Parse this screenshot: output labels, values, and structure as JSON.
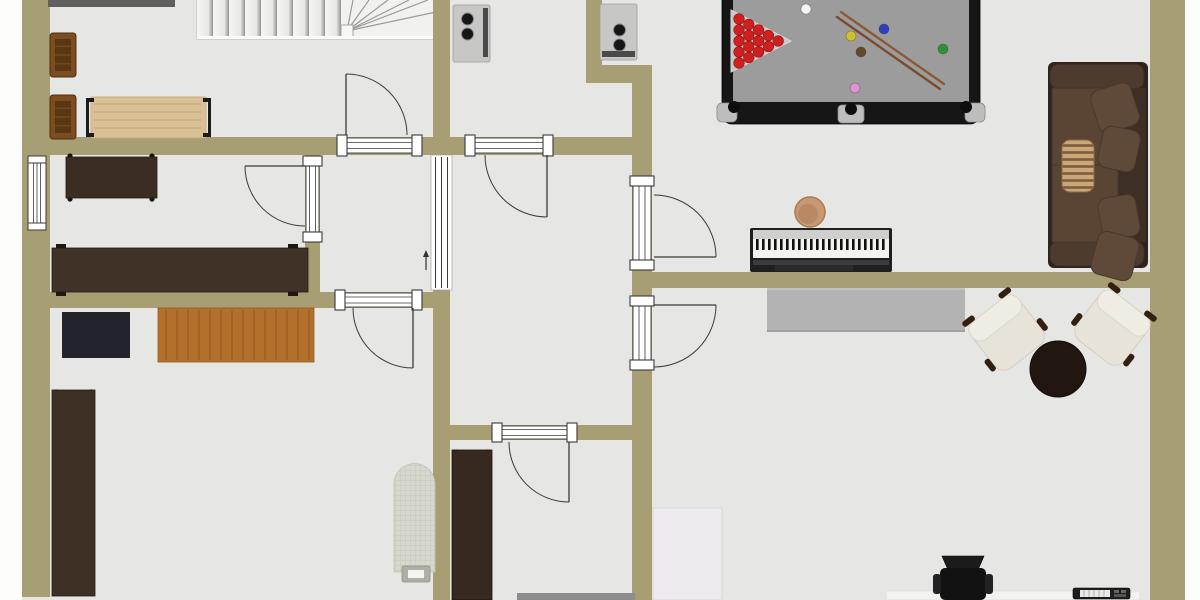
{
  "canvas": {
    "w": 1200,
    "h": 600,
    "bg": "#fdfdfc",
    "floor_color": "#e6e6e5",
    "wall_color": "#a89e73",
    "line_color": "#3a3a3a"
  },
  "floor": {
    "x": 22,
    "y": 0,
    "w": 1163,
    "h": 600
  },
  "walls": [
    {
      "x": 22,
      "y": 0,
      "w": 28,
      "h": 597
    },
    {
      "x": 1150,
      "y": 0,
      "w": 35,
      "h": 600
    },
    {
      "x": 22,
      "y": 137,
      "w": 630,
      "h": 18
    },
    {
      "x": 433,
      "y": 0,
      "w": 17,
      "h": 137
    },
    {
      "x": 433,
      "y": 290,
      "w": 17,
      "h": 310
    },
    {
      "x": 305,
      "y": 152,
      "w": 15,
      "h": 140
    },
    {
      "x": 22,
      "y": 292,
      "w": 428,
      "h": 16
    },
    {
      "x": 586,
      "y": 0,
      "w": 16,
      "h": 67
    },
    {
      "x": 586,
      "y": 65,
      "w": 66,
      "h": 18
    },
    {
      "x": 632,
      "y": 83,
      "w": 20,
      "h": 517
    },
    {
      "x": 640,
      "y": 272,
      "w": 510,
      "h": 16
    },
    {
      "x": 450,
      "y": 425,
      "w": 202,
      "h": 15
    }
  ],
  "doors_h": [
    {
      "name": "door-top-left-room",
      "x": 337,
      "y": 135,
      "w": 85,
      "h": 21
    },
    {
      "name": "door-laundry",
      "x": 465,
      "y": 135,
      "w": 88,
      "h": 21
    },
    {
      "name": "door-bottom-left-room",
      "x": 335,
      "y": 290,
      "w": 87,
      "h": 20
    },
    {
      "name": "door-bottom-middle-room",
      "x": 492,
      "y": 423,
      "w": 85,
      "h": 19
    }
  ],
  "doors_v": [
    {
      "name": "door-left-middle-room",
      "x": 303,
      "y": 156,
      "w": 19,
      "h": 86
    },
    {
      "name": "door-games-room",
      "x": 630,
      "y": 176,
      "w": 24,
      "h": 94
    },
    {
      "name": "door-lounge-room",
      "x": 630,
      "y": 296,
      "w": 24,
      "h": 74
    }
  ],
  "windows": [
    {
      "name": "window-left-wall",
      "x": 28,
      "y": 156,
      "w": 18,
      "h": 74
    }
  ],
  "sliding_door": {
    "name": "sliding-door-hallway",
    "x": 431,
    "y": 155,
    "w": 21,
    "h": 135
  },
  "door_leaves": [
    [
      346,
      74,
      346,
      135
    ],
    [
      547,
      155,
      547,
      217
    ],
    [
      245,
      166,
      305,
      166
    ],
    [
      413,
      308,
      413,
      368
    ],
    [
      654,
      257,
      716,
      257
    ],
    [
      654,
      305,
      716,
      305
    ],
    [
      569,
      442,
      569,
      502
    ]
  ],
  "door_arcs": [
    "M346 74A61 61 0 0 1 407 135",
    "M485 155A62 62 0 0 0 547 217",
    "M245 166A60 60 0 0 0 305 226",
    "M353 308A60 60 0 0 0 413 368",
    "M654 195A62 62 0 0 1 716 257",
    "M716 305A62 62 0 0 1 654 367",
    "M509 442A60 60 0 0 0 569 502"
  ],
  "arrow": {
    "x": 426,
    "y1": 270,
    "y2": 254
  },
  "stairs": {
    "x": 197,
    "y": 0,
    "w": 240,
    "h": 39,
    "tread_w": 146,
    "node": [
      341,
      25,
      12,
      12
    ],
    "pivot": [
      347,
      31
    ],
    "fan": [
      [
        353,
        0
      ],
      [
        369,
        0
      ],
      [
        388,
        0
      ],
      [
        409,
        0
      ],
      [
        428,
        0
      ],
      [
        436,
        12
      ]
    ]
  },
  "furniture": [
    {
      "name": "wall-ledge",
      "type": "rect",
      "x": 48,
      "y": 0,
      "w": 127,
      "h": 7,
      "fill": "#5f5f5f",
      "interact": false
    },
    {
      "name": "wood-armchair-1",
      "type": "wood_chair",
      "x": 50,
      "y": 33,
      "w": 26,
      "h": 44
    },
    {
      "name": "wood-armchair-2",
      "type": "wood_chair",
      "x": 50,
      "y": 95,
      "w": 26,
      "h": 44
    },
    {
      "name": "craft-table",
      "type": "bracket_table",
      "x": 86,
      "y": 97,
      "w": 125,
      "h": 41,
      "fill": "#d9c095"
    },
    {
      "name": "walnut-table",
      "type": "rect",
      "x": 66,
      "y": 157,
      "w": 91,
      "h": 41,
      "fill": "#3b2d23",
      "stroke": "#241a12",
      "feet": [
        [
          70,
          156
        ],
        [
          152,
          156
        ],
        [
          70,
          199
        ],
        [
          152,
          199
        ]
      ]
    },
    {
      "name": "long-sideboard-desk",
      "type": "rect",
      "x": 52,
      "y": 248,
      "w": 256,
      "h": 44,
      "fill": "#413227",
      "stroke": "#241a12",
      "pads": [
        [
          56,
          244,
          10,
          5
        ],
        [
          288,
          244,
          10,
          5
        ],
        [
          56,
          291,
          10,
          5
        ],
        [
          288,
          291,
          10,
          5
        ]
      ]
    },
    {
      "name": "dark-rug",
      "type": "rect",
      "x": 62,
      "y": 312,
      "w": 68,
      "h": 46,
      "fill": "#23232b"
    },
    {
      "name": "oak-desk",
      "type": "rect",
      "x": 158,
      "y": 308,
      "w": 156,
      "h": 54,
      "fill": "#b2702c",
      "stroke": "#8f5a1d",
      "grain": "v"
    },
    {
      "name": "tall-desk",
      "type": "rect",
      "x": 52,
      "y": 390,
      "w": 43,
      "h": 206,
      "fill": "#3e3025",
      "stroke": "#241a12",
      "feet": [
        [
          56,
          392
        ],
        [
          91,
          392
        ],
        [
          56,
          593
        ],
        [
          91,
          593
        ]
      ]
    },
    {
      "name": "washer-1",
      "type": "washer",
      "x": 453,
      "y": 5,
      "w": 37,
      "h": 57,
      "strip": "right"
    },
    {
      "name": "washer-2",
      "type": "washer",
      "x": 600,
      "y": 4,
      "w": 37,
      "h": 56,
      "strip": "bottom"
    },
    {
      "name": "ironing-board",
      "type": "ironing_board",
      "x": 394,
      "y": 464,
      "w": 41,
      "h": 108
    },
    {
      "name": "laundry-cabinet",
      "type": "rect",
      "x": 452,
      "y": 450,
      "w": 40,
      "h": 150,
      "fill": "#37291f",
      "stroke": "#1d140d",
      "feet": [
        [
          456,
          452
        ],
        [
          488,
          452
        ]
      ]
    },
    {
      "name": "gray-desk",
      "type": "rect",
      "x": 517,
      "y": 593,
      "w": 118,
      "h": 7,
      "fill": "#8d8d8d"
    },
    {
      "name": "white-board",
      "type": "rect",
      "x": 653,
      "y": 508,
      "w": 69,
      "h": 92,
      "fill": "#edeaed",
      "stroke": "#d6d3d6"
    },
    {
      "name": "desk-edge",
      "type": "rect",
      "x": 886,
      "y": 591,
      "w": 254,
      "h": 9,
      "fill": "#f2f2f1",
      "stroke": "#dcdcda"
    },
    {
      "name": "office-chair",
      "type": "office_chair",
      "x": 933,
      "y": 556,
      "w": 60,
      "h": 44
    },
    {
      "name": "mini-keyboard",
      "type": "keyboard_device",
      "x": 1073,
      "y": 588,
      "w": 57,
      "h": 11
    },
    {
      "name": "gray-sideboard",
      "type": "sideboard",
      "x": 767,
      "y": 288,
      "w": 198,
      "h": 44,
      "fill": "#b3b3b3"
    },
    {
      "name": "digital-piano",
      "type": "piano",
      "x": 750,
      "y": 228,
      "w": 142,
      "h": 44
    },
    {
      "name": "piano-stool",
      "type": "stool",
      "cx": 810,
      "cy": 212,
      "r": 15,
      "fill": "#c69873"
    },
    {
      "name": "coffee-table",
      "type": "circle",
      "cx": 1058,
      "cy": 369,
      "r": 28,
      "fill": "#221710",
      "stroke": "#120b07"
    }
  ],
  "pool_table": {
    "x": 722,
    "y": -16,
    "w": 258,
    "h": 140,
    "rail": "#161616",
    "felt": "#9c9c9c",
    "plate": [
      [
        731,
        10
      ],
      [
        731,
        72
      ],
      [
        791,
        41
      ]
    ],
    "red_balls": [
      [
        739,
        19
      ],
      [
        739,
        30
      ],
      [
        739,
        41
      ],
      [
        739,
        52
      ],
      [
        739,
        63
      ],
      [
        748.8,
        24.5
      ],
      [
        748.8,
        35.5
      ],
      [
        748.8,
        46.5
      ],
      [
        748.8,
        57.5
      ],
      [
        758.6,
        30
      ],
      [
        758.6,
        41
      ],
      [
        758.6,
        52
      ],
      [
        768.4,
        35.5
      ],
      [
        768.4,
        46.5
      ],
      [
        778.2,
        41
      ]
    ],
    "balls": [
      {
        "name": "cue-ball",
        "x": 806,
        "y": 9,
        "c": "#f6f6f4"
      },
      {
        "name": "yellow-ball",
        "x": 851,
        "y": 36,
        "c": "#cfc12c"
      },
      {
        "name": "blue-ball",
        "x": 884,
        "y": 29,
        "c": "#2b41bd"
      },
      {
        "name": "brown-ball",
        "x": 861,
        "y": 52,
        "c": "#64492a"
      },
      {
        "name": "green-ball",
        "x": 943,
        "y": 49,
        "c": "#2f9133"
      },
      {
        "name": "pink-ball",
        "x": 855,
        "y": 88,
        "c": "#dc94d4"
      }
    ],
    "cues": [
      [
        841,
        12,
        944,
        84
      ],
      [
        837,
        17,
        940,
        89
      ]
    ],
    "caps": [
      [
        717,
        103
      ],
      [
        965,
        103
      ]
    ],
    "tab": [
      838,
      105,
      26,
      18
    ],
    "holes": [
      [
        734,
        107
      ],
      [
        966,
        107
      ],
      [
        851,
        109
      ]
    ]
  },
  "sofa": {
    "x": 1048,
    "y": 62,
    "w": 100,
    "h": 206,
    "frame": "#2e241d",
    "arm": "#4c3b2e",
    "cushion": "#5a4535",
    "back": "#3d2f26",
    "pillows": [
      [
        1094,
        86,
        42,
        44,
        -18
      ],
      [
        1100,
        128,
        38,
        42,
        12
      ],
      [
        1100,
        196,
        38,
        42,
        -10
      ],
      [
        1094,
        234,
        42,
        44,
        15
      ]
    ],
    "striped_pillow": [
      1062,
      140,
      32,
      52
    ]
  },
  "armchairs": [
    {
      "name": "lounge-armchair-1",
      "cx": 1007,
      "cy": 333,
      "rot": -38
    },
    {
      "name": "lounge-armchair-2",
      "cx": 1112,
      "cy": 328,
      "rot": 38
    }
  ]
}
